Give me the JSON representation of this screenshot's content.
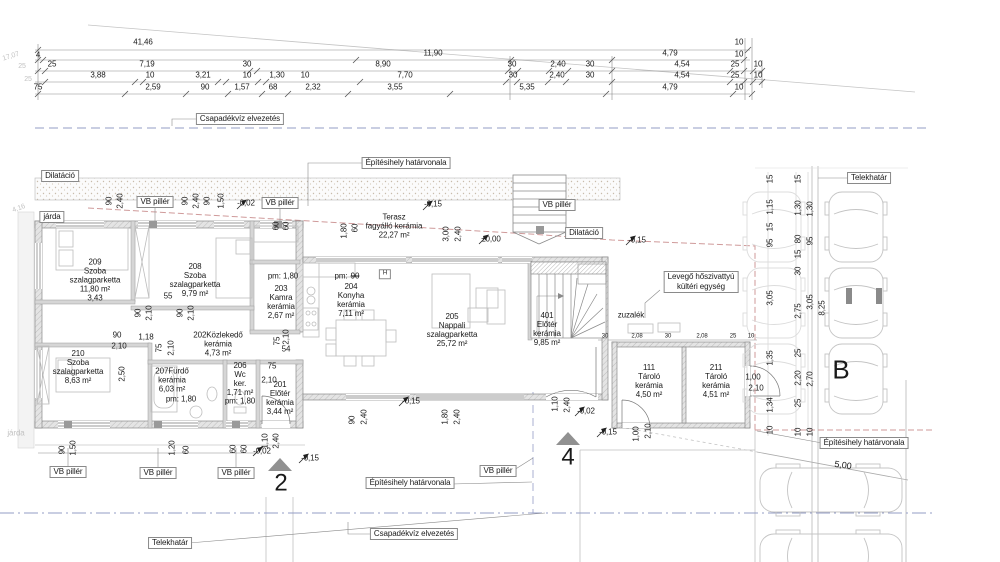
{
  "title": "Floor plan – földszinti alaprajz (site/floor plan with parking)",
  "colors": {
    "text": "#1a1a1a",
    "faint": "#c2c2c2",
    "line": "#8a8a8a",
    "blue": "#939cc6",
    "red": "#cf9a9a",
    "wall": "#d6d6d6",
    "marker": "#919191"
  },
  "texts": [
    [
      "dim-total",
      "41,46",
      143,
      43
    ],
    [
      "dim",
      "10",
      739,
      43
    ],
    [
      "dim",
      "4",
      38,
      56
    ],
    [
      "dim",
      "11,90",
      433,
      54
    ],
    [
      "dim",
      "4,79",
      670,
      54
    ],
    [
      "dim",
      "10",
      739,
      55
    ],
    [
      "dim",
      "25",
      52,
      65
    ],
    [
      "dim",
      "7,19",
      147,
      65
    ],
    [
      "dim",
      "30",
      247,
      65
    ],
    [
      "dim",
      "8,90",
      383,
      65
    ],
    [
      "dim",
      "30",
      512,
      65
    ],
    [
      "dim",
      "2,40",
      558,
      65
    ],
    [
      "dim",
      "30",
      590,
      65
    ],
    [
      "dim",
      "4,54",
      682,
      65
    ],
    [
      "dim",
      "25",
      735,
      65
    ],
    [
      "dim",
      "10",
      758,
      65
    ],
    [
      "dim",
      "3,88",
      98,
      76
    ],
    [
      "dim",
      "10",
      150,
      76
    ],
    [
      "dim",
      "3,21",
      203,
      76
    ],
    [
      "dim",
      "10",
      247,
      76
    ],
    [
      "dim",
      "1,30",
      277,
      76
    ],
    [
      "dim",
      "10",
      305,
      76
    ],
    [
      "dim",
      "7,70",
      405,
      76
    ],
    [
      "dim",
      "30",
      513,
      76
    ],
    [
      "dim",
      "2,40",
      557,
      76
    ],
    [
      "dim",
      "30",
      590,
      76
    ],
    [
      "dim",
      "4,54",
      682,
      76
    ],
    [
      "dim",
      "25",
      735,
      76
    ],
    [
      "dim",
      "10",
      758,
      76
    ],
    [
      "dim",
      "75",
      38,
      88
    ],
    [
      "dim",
      "2,59",
      153,
      88
    ],
    [
      "dim",
      "90",
      205,
      88
    ],
    [
      "dim",
      "1,57",
      242,
      88
    ],
    [
      "dim",
      "68",
      273,
      88
    ],
    [
      "dim",
      "2,32",
      313,
      88
    ],
    [
      "dim",
      "3,55",
      395,
      88
    ],
    [
      "dim",
      "5,35",
      527,
      88
    ],
    [
      "dim",
      "4,79",
      670,
      88
    ],
    [
      "dim",
      "10",
      739,
      88
    ],
    [
      "dim-faint",
      "17,07",
      11,
      57,
      {
        "r": -18,
        "c": "faint",
        "s": 7
      }
    ],
    [
      "dim-faint",
      "25",
      22,
      67,
      {
        "c": "faint",
        "s": 7
      }
    ],
    [
      "dim-faint",
      "25",
      28,
      80,
      {
        "c": "faint",
        "s": 7
      }
    ],
    [
      "dim-faint",
      "4,16",
      19,
      209,
      {
        "r": -20,
        "c": "faint",
        "s": 7
      }
    ],
    [
      "label-jarda-faint",
      "járda",
      16,
      434,
      {
        "c": "faint"
      }
    ],
    [
      "box-csapadekviz-top",
      "Csapadékvíz elvezetés",
      240,
      119,
      {
        "b": 1
      }
    ],
    [
      "box-epitesihely-top",
      "Építésihely határvonala",
      406,
      163,
      {
        "b": 1
      }
    ],
    [
      "box-dilatacio-left",
      "Dilatáció",
      60,
      176,
      {
        "b": 1
      }
    ],
    [
      "box-jarda",
      "járda",
      52,
      217,
      {
        "b": 1
      }
    ],
    [
      "box-vb-pillar-1",
      "VB pillér",
      155,
      202,
      {
        "b": 1
      }
    ],
    [
      "box-vb-pillar-2",
      "VB pillér",
      280,
      203,
      {
        "b": 1
      }
    ],
    [
      "box-vb-pillar-3",
      "VB pillér",
      557,
      205,
      {
        "b": 1
      }
    ],
    [
      "box-dilatacio-right",
      "Dilatáció",
      584,
      233,
      {
        "b": 1
      }
    ],
    [
      "box-heatpump",
      "Levegő hőszivattyú\nkültéri egység",
      701,
      282,
      {
        "b": 1
      }
    ],
    [
      "box-telekhatar-top",
      "Telekhatár",
      869,
      178,
      {
        "b": 1
      }
    ],
    [
      "box-vb-pillar-4",
      "VB pillér",
      68,
      472,
      {
        "b": 1
      }
    ],
    [
      "box-vb-pillar-5",
      "VB pillér",
      158,
      473,
      {
        "b": 1
      }
    ],
    [
      "box-vb-pillar-6",
      "VB pillér",
      236,
      473,
      {
        "b": 1
      }
    ],
    [
      "box-vb-pillar-7",
      "VB pillér",
      498,
      471,
      {
        "b": 1
      }
    ],
    [
      "box-epitesihely-bottom",
      "Építésihely határvonala",
      410,
      483,
      {
        "b": 1
      }
    ],
    [
      "box-csapadekviz-bottom",
      "Csapadékvíz elvezetés",
      414,
      534,
      {
        "b": 1
      }
    ],
    [
      "box-telekhatar-bottom",
      "Telekhatár",
      170,
      543,
      {
        "b": 1
      }
    ],
    [
      "box-epitesihely-right",
      "Építésihely határvonala",
      864,
      443,
      {
        "b": 1
      }
    ],
    [
      "room-209",
      "209\nSzoba\nszalagparketta\n11,80 m²\n3,43",
      95,
      281
    ],
    [
      "room-208",
      "208\nSzoba\nszalagparketta\n9,79 m²",
      195,
      281
    ],
    [
      "room-203",
      "203\nKamra\nkerámia\n2,67 m²",
      281,
      303
    ],
    [
      "room-204",
      "204\nKonyha\nkerámia\n7,11 m²",
      351,
      301
    ],
    [
      "room-205",
      "205\nNappali\nszalagparketta\n25,72 m²",
      452,
      331
    ],
    [
      "room-401",
      "401\nElőtér\nkerámia\n9,85 m²",
      547,
      330
    ],
    [
      "room-202",
      "202Közlekedő\nkerámia\n4,73 m²",
      218,
      345
    ],
    [
      "room-210",
      "210\nSzoba\nszalagparketta\n8,63 m²",
      78,
      368
    ],
    [
      "room-207",
      "207Fürdő\nkerámia\n6,03 m²",
      172,
      381
    ],
    [
      "room-206",
      "206\nWc\nker.\n1,71 m²",
      240,
      380
    ],
    [
      "room-201",
      "201\nElőtér\nkerámia\n3,44 m²",
      280,
      399
    ],
    [
      "room-111",
      "111\nTároló\nkerámia\n4,50 m²",
      649,
      382
    ],
    [
      "room-211",
      "211\nTároló\nkerámia\n4,51 m²",
      716,
      382
    ],
    [
      "label-terasz",
      "Terasz\nfagyálló kerámia\n22,27 m²",
      394,
      227
    ],
    [
      "label-zuzalek",
      "zuzalék",
      631,
      316
    ],
    [
      "pm-kamra",
      "pm: 1,80",
      283,
      277
    ],
    [
      "pm-konyha-a",
      "pm:",
      341,
      277
    ],
    [
      "pm-konyha-b",
      "90",
      355,
      277,
      {
        "st": 1
      }
    ],
    [
      "pm-furdo",
      "pm: 1,80",
      181,
      400
    ],
    [
      "pm-wc",
      "pm: 1,80",
      240,
      402
    ],
    [
      "level",
      "-0,02",
      246,
      204
    ],
    [
      "level",
      "-0,15",
      433,
      205
    ],
    [
      "level",
      "±0,00",
      491,
      240
    ],
    [
      "level",
      "-0,15",
      637,
      241
    ],
    [
      "level",
      "-0,15",
      411,
      402
    ],
    [
      "level",
      "-0,02",
      586,
      412
    ],
    [
      "level",
      "-0,15",
      608,
      433
    ],
    [
      "level",
      "-0,15",
      310,
      459
    ],
    [
      "level",
      "-0,02",
      262,
      452
    ],
    [
      "vdim",
      "90",
      110,
      201,
      {
        "r": -90
      }
    ],
    [
      "vdim",
      "2,40",
      121,
      201,
      {
        "r": -90
      }
    ],
    [
      "vdim",
      "90",
      186,
      201,
      {
        "r": -90
      }
    ],
    [
      "vdim",
      "2,40",
      197,
      201,
      {
        "r": -90
      }
    ],
    [
      "vdim",
      "90",
      208,
      201,
      {
        "r": -90
      }
    ],
    [
      "vdim",
      "1,50",
      222,
      201,
      {
        "r": -90
      }
    ],
    [
      "vdim",
      "60",
      277,
      226,
      {
        "r": -90
      }
    ],
    [
      "vdim",
      "60",
      287,
      226,
      {
        "r": -90
      }
    ],
    [
      "vdim",
      "1,80",
      345,
      231,
      {
        "r": -90
      }
    ],
    [
      "vdim",
      "60",
      356,
      228,
      {
        "r": -90
      }
    ],
    [
      "vdim",
      "3,00",
      447,
      234,
      {
        "r": -90
      }
    ],
    [
      "vdim",
      "2,40",
      459,
      234,
      {
        "r": -90
      }
    ],
    [
      "vdim",
      "15",
      771,
      179,
      {
        "r": -90
      }
    ],
    [
      "vdim",
      "1,15",
      771,
      207,
      {
        "r": -90
      }
    ],
    [
      "vdim",
      "15",
      771,
      227,
      {
        "r": -90
      }
    ],
    [
      "vdim",
      "95",
      771,
      243,
      {
        "r": -90
      }
    ],
    [
      "vdim",
      "3,05",
      771,
      298,
      {
        "r": -90
      }
    ],
    [
      "vdim",
      "1,35",
      771,
      358,
      {
        "r": -90
      }
    ],
    [
      "vdim",
      "1,34",
      771,
      405,
      {
        "r": -90
      }
    ],
    [
      "vdim",
      "10",
      771,
      430,
      {
        "r": -90
      }
    ],
    [
      "vdim",
      "15",
      799,
      179,
      {
        "r": -90
      }
    ],
    [
      "vdim",
      "1,30",
      799,
      208,
      {
        "r": -90
      }
    ],
    [
      "vdim",
      "80",
      799,
      239,
      {
        "r": -90
      }
    ],
    [
      "vdim",
      "15",
      799,
      254,
      {
        "r": -90
      }
    ],
    [
      "vdim",
      "30",
      799,
      271,
      {
        "r": -90
      }
    ],
    [
      "vdim",
      "2,75",
      799,
      311,
      {
        "r": -90
      }
    ],
    [
      "vdim",
      "25",
      799,
      353,
      {
        "r": -90
      }
    ],
    [
      "vdim",
      "2,20",
      799,
      378,
      {
        "r": -90
      }
    ],
    [
      "vdim",
      "25",
      799,
      403,
      {
        "r": -90
      }
    ],
    [
      "vdim",
      "10",
      799,
      432,
      {
        "r": -90
      }
    ],
    [
      "vdim",
      "1,30",
      811,
      209,
      {
        "r": -90
      }
    ],
    [
      "vdim",
      "95",
      811,
      241,
      {
        "r": -90
      }
    ],
    [
      "vdim",
      "3,05",
      811,
      302,
      {
        "r": -90
      }
    ],
    [
      "vdim",
      "2,70",
      811,
      379,
      {
        "r": -90
      }
    ],
    [
      "vdim",
      "10",
      811,
      432,
      {
        "r": -90
      }
    ],
    [
      "vdim",
      "8,25",
      823,
      308,
      {
        "r": -90
      }
    ],
    [
      "vdim",
      "90",
      63,
      450,
      {
        "r": -90
      }
    ],
    [
      "vdim",
      "1,50",
      74,
      448,
      {
        "r": -90
      }
    ],
    [
      "vdim",
      "1,20",
      173,
      448,
      {
        "r": -90
      }
    ],
    [
      "vdim",
      "60",
      187,
      450,
      {
        "r": -90
      }
    ],
    [
      "vdim",
      "60",
      234,
      449,
      {
        "r": -90
      }
    ],
    [
      "vdim",
      "60",
      245,
      449,
      {
        "r": -90
      }
    ],
    [
      "vdim",
      "90",
      353,
      420,
      {
        "r": -90
      }
    ],
    [
      "vdim",
      "2,40",
      365,
      417,
      {
        "r": -90
      }
    ],
    [
      "vdim",
      "1,80",
      446,
      417,
      {
        "r": -90
      }
    ],
    [
      "vdim",
      "2,40",
      458,
      417,
      {
        "r": -90
      }
    ],
    [
      "vdim",
      "1,10",
      556,
      404,
      {
        "r": -90
      }
    ],
    [
      "vdim",
      "2,40",
      568,
      405,
      {
        "r": -90
      }
    ],
    [
      "vdim",
      "1,10",
      266,
      441,
      {
        "r": -90
      }
    ],
    [
      "vdim",
      "2,40",
      277,
      441,
      {
        "r": -90
      }
    ],
    [
      "vdim",
      "1,00",
      637,
      434,
      {
        "r": -90
      }
    ],
    [
      "vdim",
      "2,10",
      649,
      431,
      {
        "r": -90
      }
    ],
    [
      "vdim",
      "90",
      139,
      313,
      {
        "r": -90
      }
    ],
    [
      "vdim",
      "2,10",
      150,
      313,
      {
        "r": -90
      }
    ],
    [
      "vdim",
      "90",
      181,
      313,
      {
        "r": -90
      }
    ],
    [
      "vdim",
      "2,10",
      192,
      313,
      {
        "r": -90
      }
    ],
    [
      "vdim",
      "75",
      160,
      348,
      {
        "r": -90
      }
    ],
    [
      "vdim",
      "2,10",
      172,
      348,
      {
        "r": -90
      }
    ],
    [
      "vdim",
      "2,50",
      123,
      374,
      {
        "r": -90
      }
    ],
    [
      "vdim",
      "75",
      278,
      341,
      {
        "r": -90
      }
    ],
    [
      "vdim",
      "2,10",
      287,
      337,
      {
        "r": -90
      }
    ],
    [
      "dim",
      "55",
      168,
      297
    ],
    [
      "dim",
      "90",
      117,
      336
    ],
    [
      "dim",
      "2,10",
      119,
      347
    ],
    [
      "dim",
      "1,18",
      146,
      338
    ],
    [
      "dim",
      "54",
      286,
      350
    ],
    [
      "dim",
      "75",
      272,
      367
    ],
    [
      "dim",
      "2,10",
      269,
      381
    ],
    [
      "dim",
      "1,00",
      753,
      378
    ],
    [
      "dim",
      "2,10",
      756,
      389
    ],
    [
      "dim",
      "30",
      605,
      337,
      {
        "s": 6
      }
    ],
    [
      "dim",
      "2,08",
      637,
      337,
      {
        "s": 6
      }
    ],
    [
      "dim",
      "30",
      668,
      337,
      {
        "s": 6
      }
    ],
    [
      "dim",
      "2,08",
      702,
      337,
      {
        "s": 6
      }
    ],
    [
      "dim",
      "25",
      733,
      337,
      {
        "s": 6
      }
    ],
    [
      "dim",
      "10",
      751,
      337,
      {
        "s": 6
      }
    ],
    [
      "letter-B",
      "B",
      841,
      370,
      {
        "s": 26
      }
    ],
    [
      "section-2-number",
      "2",
      281,
      484,
      {
        "s": 24
      }
    ],
    [
      "section-4-number",
      "4",
      568,
      458,
      {
        "s": 24
      }
    ],
    [
      "slope-dim",
      "5,00",
      843,
      465,
      {
        "r": 8,
        "s": 9
      }
    ],
    [
      "mark-H",
      "H",
      385,
      274,
      {
        "s": 6,
        "b": 1
      }
    ]
  ],
  "ticks": [
    {
      "y": 50,
      "xs": [
        38,
        748
      ]
    },
    {
      "y": 60,
      "xs": [
        38,
        43,
        356,
        511,
        612,
        744
      ]
    },
    {
      "y": 71,
      "xs": [
        38,
        45,
        250,
        257,
        508,
        518,
        549,
        568,
        612,
        730,
        744,
        753,
        762
      ]
    },
    {
      "y": 82,
      "xs": [
        45,
        135,
        143,
        218,
        226,
        258,
        266,
        360,
        506,
        517,
        548,
        566,
        612,
        730,
        744,
        753,
        762
      ]
    },
    {
      "y": 94,
      "xs": [
        38,
        125,
        186,
        228,
        262,
        288,
        348,
        450,
        606,
        733,
        752
      ]
    }
  ],
  "flags": [
    [
      237,
      209
    ],
    [
      423,
      210
    ],
    [
      479,
      244
    ],
    [
      626,
      245
    ],
    [
      399,
      406
    ],
    [
      575,
      416
    ],
    [
      597,
      437
    ],
    [
      299,
      463
    ],
    [
      253,
      456
    ]
  ]
}
